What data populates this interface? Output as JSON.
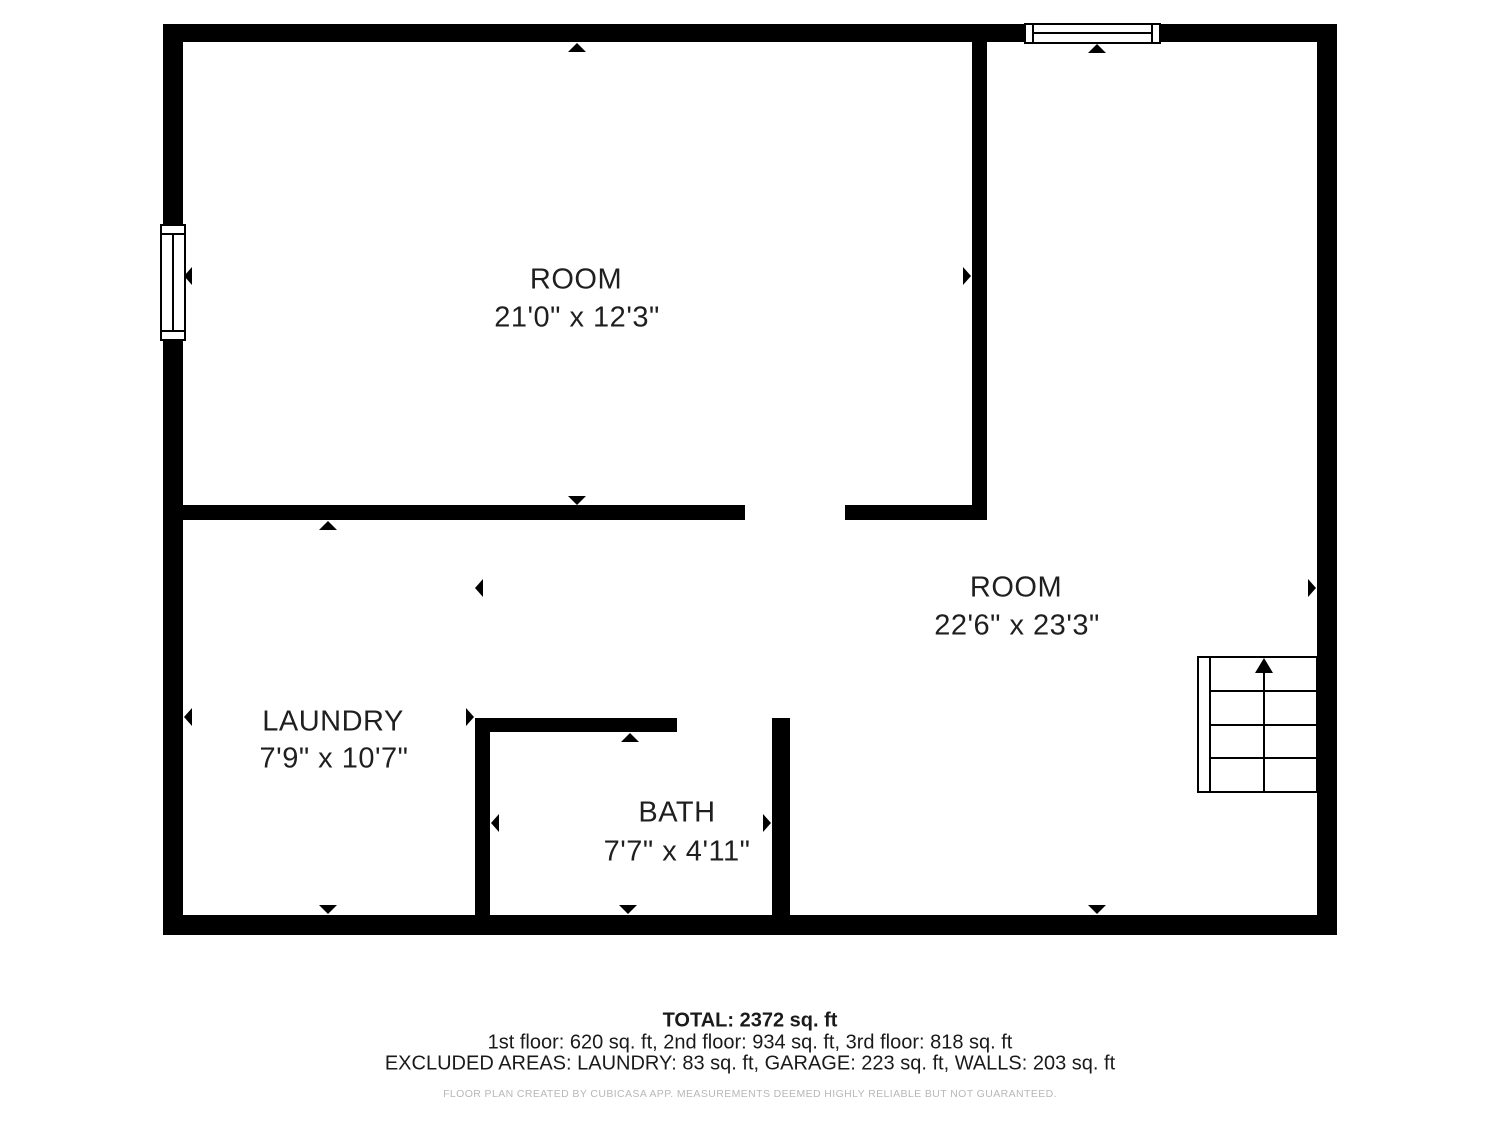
{
  "rooms": [
    {
      "name": "ROOM",
      "dimensions": "21'0\" x 12'3\""
    },
    {
      "name": "ROOM",
      "dimensions": "22'6\" x 23'3\""
    },
    {
      "name": "LAUNDRY",
      "dimensions": "7'9\" x 10'7\""
    },
    {
      "name": "BATH",
      "dimensions": "7'7\" x 4'11\""
    }
  ],
  "footer": {
    "total": "TOTAL: 2372 sq. ft",
    "floor_breakdown": "1st floor: 620 sq. ft, 2nd floor: 934 sq. ft, 3rd floor: 818 sq. ft",
    "excluded_areas": "EXCLUDED AREAS: LAUNDRY: 83 sq. ft, GARAGE: 223 sq. ft, WALLS: 203 sq. ft",
    "disclaimer": "FLOOR PLAN CREATED BY CUBICASA APP. MEASUREMENTS DEEMED HIGHLY RELIABLE BUT NOT GUARANTEED."
  },
  "colors": {
    "wall": "#000000",
    "label_text": "#1f1f1f",
    "footer_text": "#1a1a1a",
    "disclaimer_text": "#b8b8b8",
    "background": "#ffffff"
  }
}
